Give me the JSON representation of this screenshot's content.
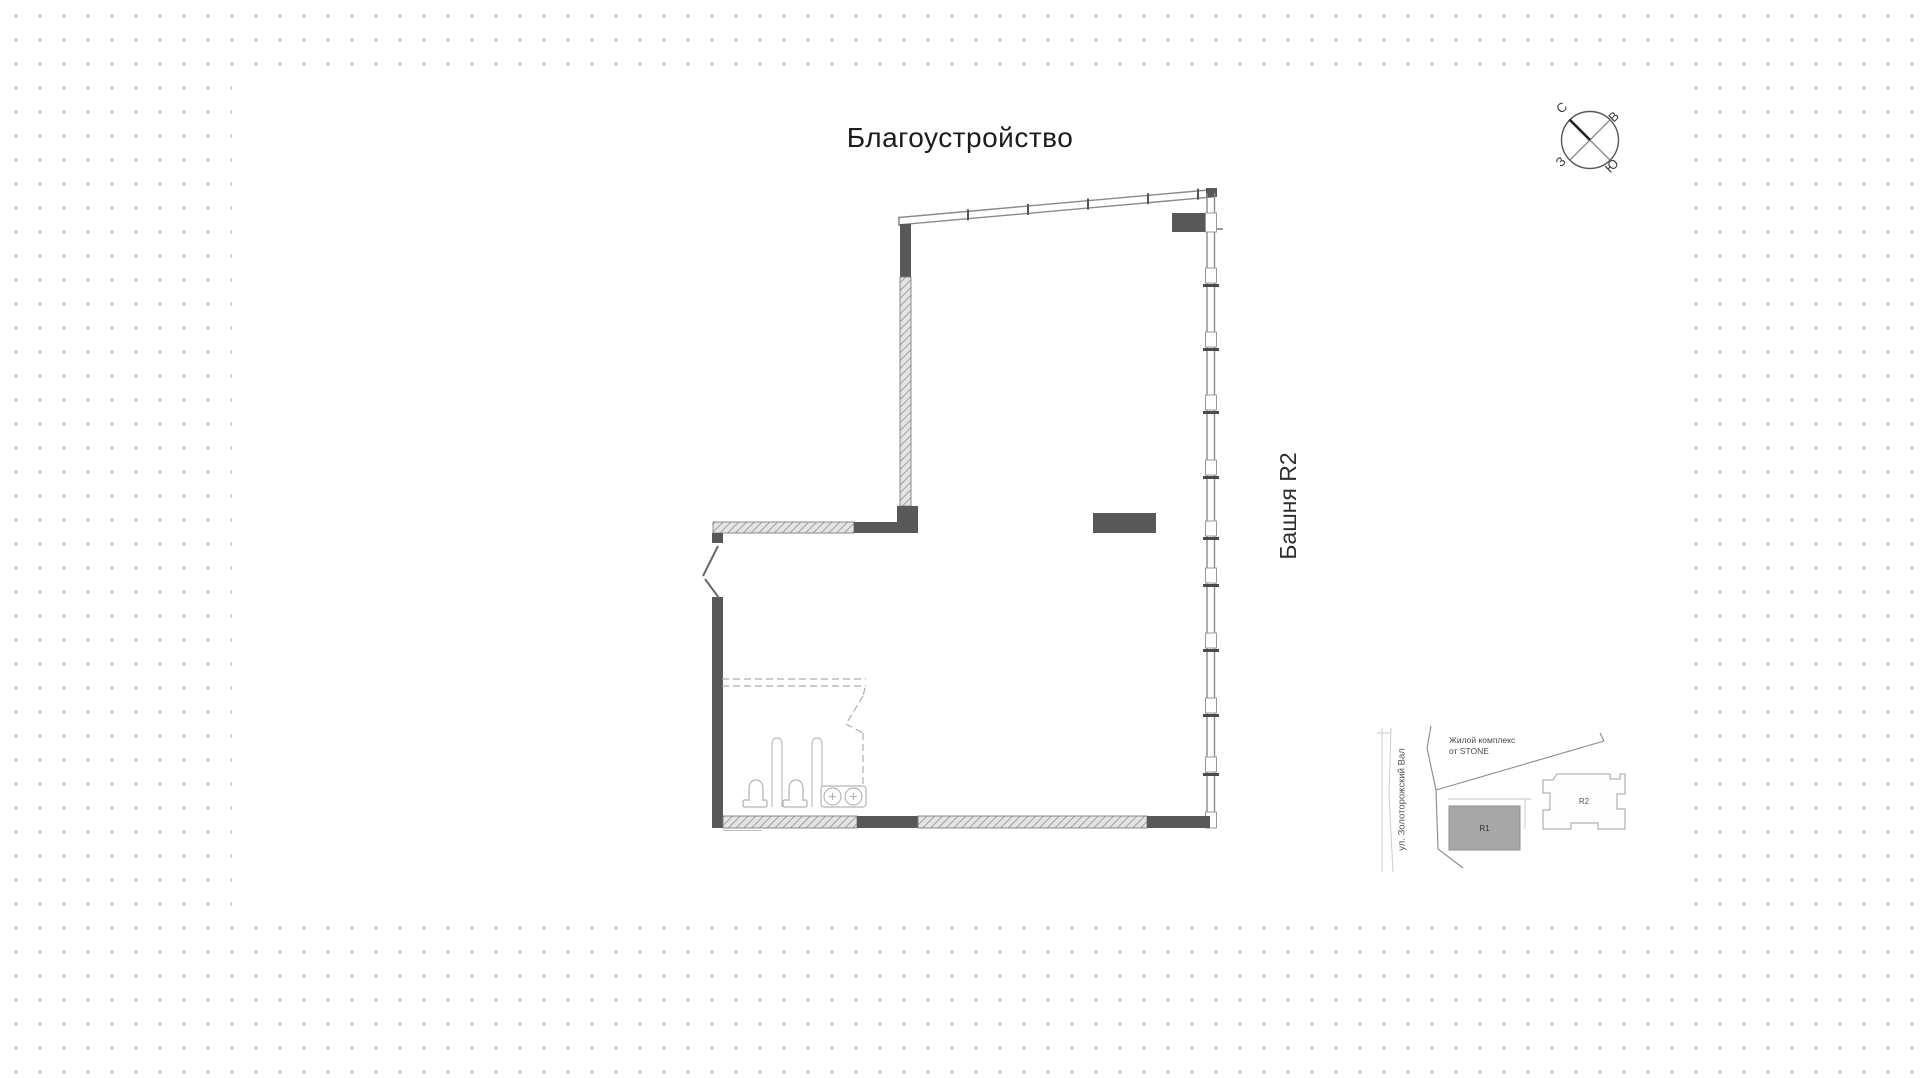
{
  "page": {
    "title": "Благоустройство"
  },
  "plan": {
    "tower_label": "Башня R2"
  },
  "compass": {
    "north": "С",
    "east": "В",
    "south": "Ю",
    "west": "З"
  },
  "minimap": {
    "street_label": "ул. Золоторожский Вал",
    "complex_label_line1": "Жилой комплекс",
    "complex_label_line2": "от STONE",
    "r1_label": "R1",
    "r2_label": "R2"
  },
  "colors": {
    "wall_dark": "#58585a",
    "wall_outline": "#8a8a8a",
    "hatch_line": "#8f8f8f",
    "hatch_bg": "#e4e4e4",
    "background_dot": "#c9c9c9",
    "r1_fill": "#a7a7a7",
    "title_text": "#1c1c1c"
  }
}
